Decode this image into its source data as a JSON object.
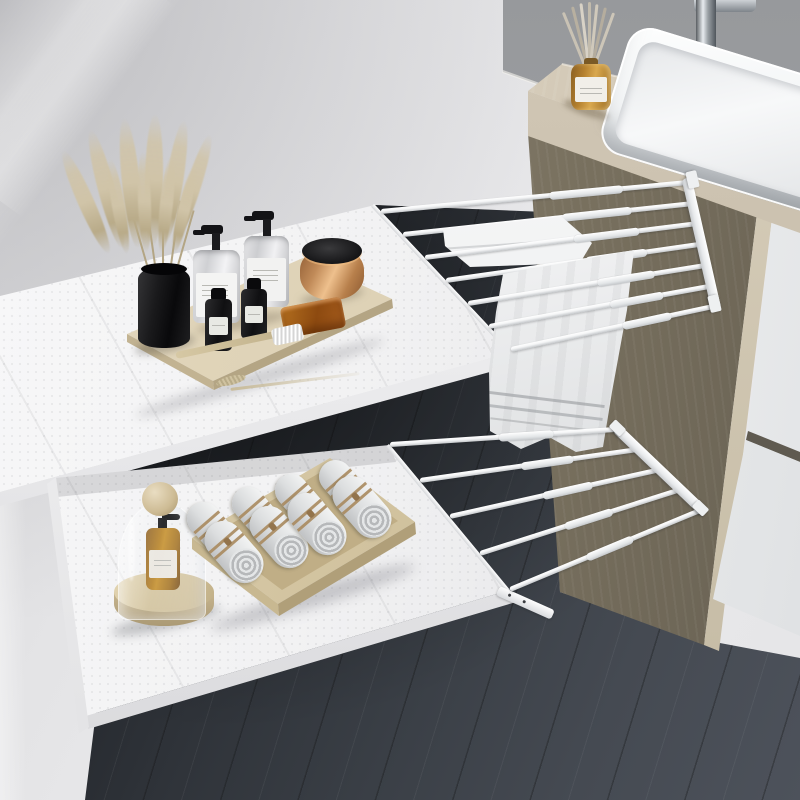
{
  "scene": {
    "type": "product-photograph",
    "room": "bathroom",
    "description": "White extendable under-shelf organizers with telescoping towel rods mounted between a wall and a wooden vanity cabinet with a white vessel sink",
    "visible_text": "none"
  },
  "palette": {
    "wall": "#e4e4e6",
    "gray-band": "#a0a2a5",
    "floor-dark": "#121419",
    "floor-mid": "#2e3238",
    "floor-light": "#4d525b",
    "counter-top": "#d6ccba",
    "counter-face": "#c6bcaa",
    "panel-light": "#97907f",
    "panel-dark": "#676052",
    "wood-trim": "#d2c8b3",
    "drawer-white": "#f7f8f8",
    "shelf": "#f2f2f3",
    "shelf-lip": "#fbfbfc",
    "rod": "#f4f5f6",
    "rod-shade": "#c6c9cc",
    "towel-light": "#f6f7f7",
    "towel-shade": "#cdd0d2",
    "tray-wood": "#ddd1b5",
    "tray-wood-dark": "#bfae88",
    "vase-black": "#131315",
    "pampas": "#d0c4a8",
    "glass-amber": "#b5812f",
    "amber-deep": "#8a5a1a",
    "copper": "#c9915c",
    "soap": "#a55c1d",
    "twine": "#a98a5e",
    "sink-white": "#fcfdfd",
    "chrome-dark": "#5a5e62",
    "chrome-light": "#e8ecef"
  },
  "objects": {
    "counts": {
      "top_rods": 7,
      "bottom_rods": 5,
      "hanging_towels": 2,
      "rolled_towels": 8,
      "pump_bottles": 2,
      "small_black_bottles": 2,
      "drawers": 2
    },
    "top_shelf_items": [
      "wooden-tray",
      "black-vase-with-pampas-grass",
      "pump-bottle",
      "pump-bottle",
      "small-black-bottle",
      "small-black-bottle",
      "copper-jar-black-lid",
      "amber-soap-bar",
      "wooden-toothbrush",
      "dried-stalk"
    ],
    "bottom_shelf_items": [
      "glass-cloche-with-amber-pump-bottle",
      "wooden-round-base",
      "wooden-towel-tray",
      "rolled-white-towels"
    ],
    "vanity_items": [
      "white-vessel-sink",
      "chrome-faucet",
      "amber-reed-diffuser"
    ]
  }
}
